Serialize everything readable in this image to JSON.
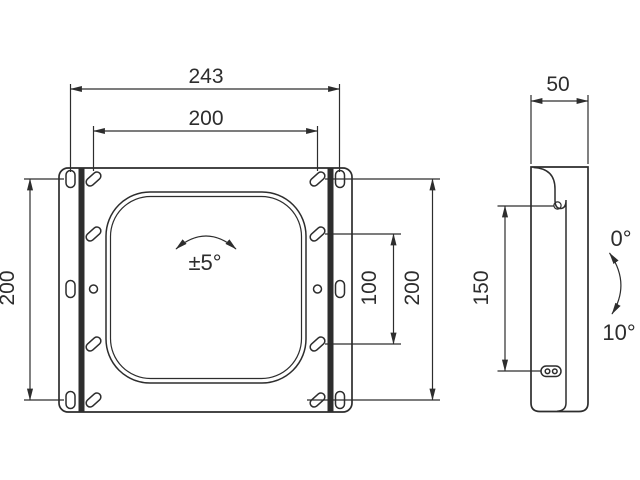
{
  "drawing": {
    "kind": "bracket-mounting-technical-drawing",
    "colors": {
      "ink": "#2d2d2d",
      "background": "#ffffff"
    },
    "front_view": {
      "dim_outer_width": "243",
      "dim_inner_width": "200",
      "dim_left_height": "200",
      "dim_right_height": "200",
      "dim_inner_height": "100",
      "rotation_range": "±5°"
    },
    "side_view": {
      "dim_depth": "50",
      "dim_slot_height": "150",
      "tilt_min": "0°",
      "tilt_max": "10°"
    }
  }
}
